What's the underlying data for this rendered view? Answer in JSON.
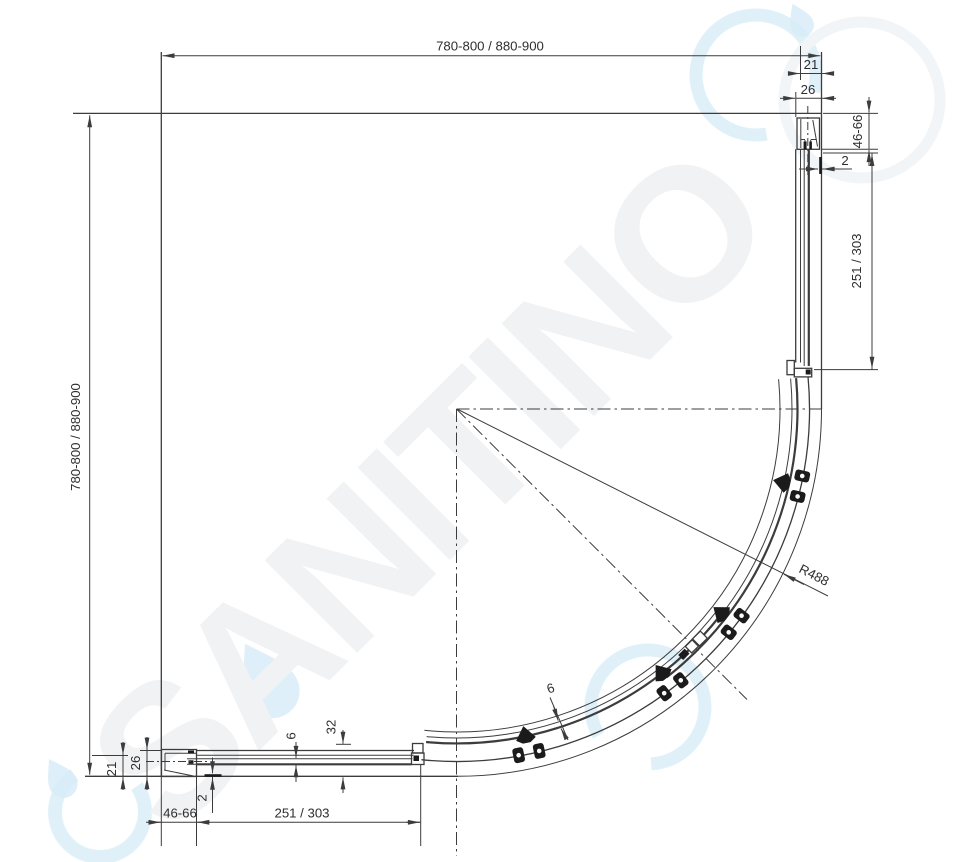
{
  "watermark": {
    "brand": "SANITINO"
  },
  "labels": {
    "top_width": "780-800 / 880-900",
    "left_height": "780-800 / 880-900",
    "offset_21": "21",
    "profile_26": "26",
    "wall_profile_range": "46-66",
    "glass_gap": "2",
    "fixed_panel_length": "251 / 303",
    "glass_thickness": "6",
    "rail_width": "32",
    "radius": "R488"
  },
  "colors": {
    "line": "#3c3c3c",
    "dimension_text": "#2e2e2e",
    "hardware": "#1b1b1b",
    "watermark_letters": "#f1f2f3",
    "watermark_droplet": "#d8edf8",
    "background": "#ffffff"
  }
}
